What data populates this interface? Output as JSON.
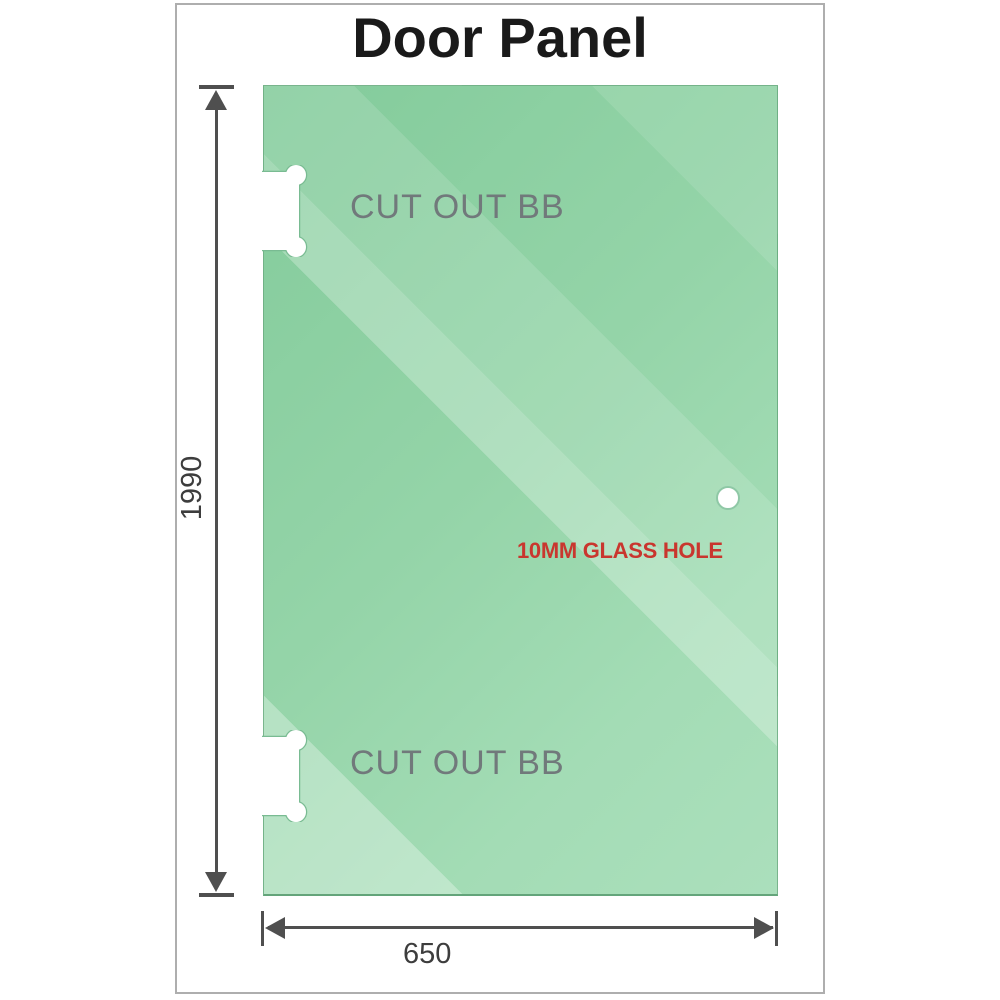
{
  "title": "Door Panel",
  "panel": {
    "cutouts": [
      {
        "label": "CUT OUT BB"
      },
      {
        "label": "CUT OUT BB"
      }
    ],
    "hole": {
      "label": "10MM GLASS HOLE"
    }
  },
  "dimensions": {
    "height": {
      "label": "1990"
    },
    "width": {
      "label": "650"
    }
  },
  "colors": {
    "glass_base": "#83cb9b",
    "glass_highlight": "#abdfbc",
    "cutout_label_gray": "#71797b",
    "hole_label_red": "#c9362e",
    "dimension_line": "#4f4f4f",
    "frame_border": "#aeaeae",
    "title_text": "#1a1a1a"
  }
}
